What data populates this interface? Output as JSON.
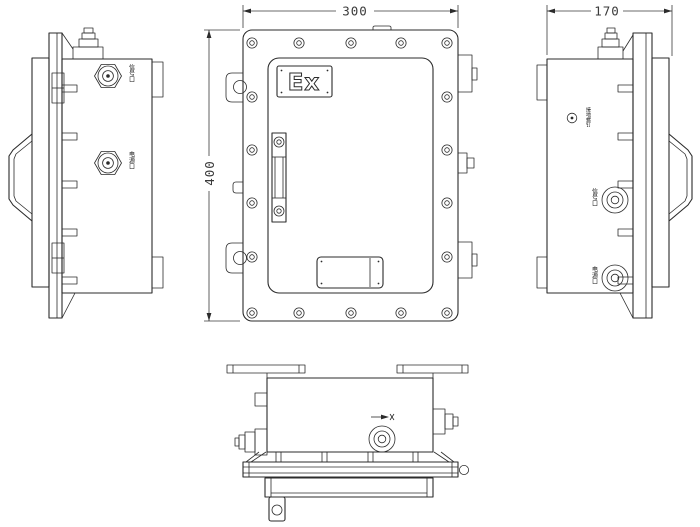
{
  "colors": {
    "line": "#2b2b2b",
    "background": "#ffffff",
    "dimension": "#3a3a3a"
  },
  "dimensions": {
    "width": "300",
    "height": "400",
    "depth": "170"
  },
  "front_view": {
    "ex_marking": "Ex"
  },
  "left_view": {
    "port_top_label": "信号口",
    "port_bottom_label": "电源口"
  },
  "right_view": {
    "ground_label": "接地螺钉",
    "port_top_label": "信号口",
    "port_bottom_label": "电源口"
  }
}
